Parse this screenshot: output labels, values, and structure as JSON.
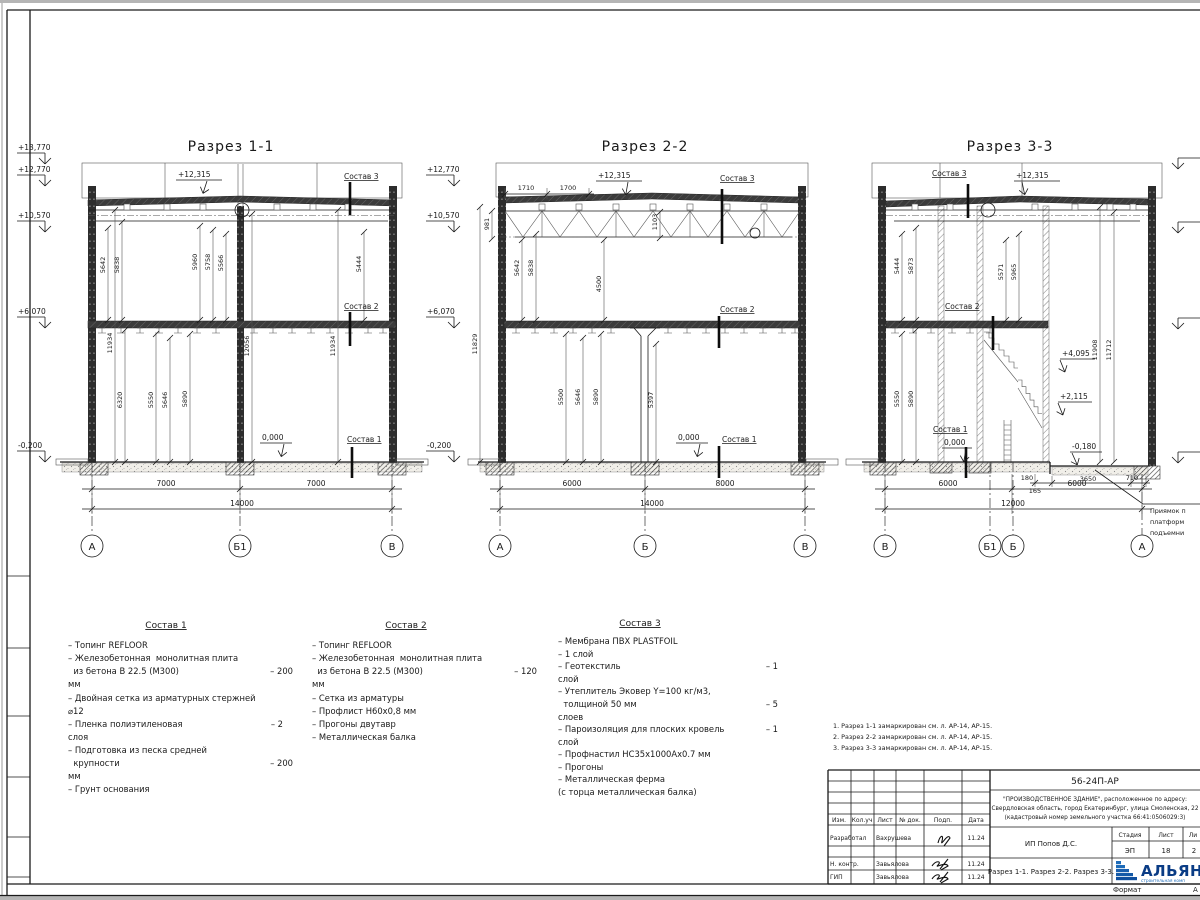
{
  "colors": {
    "line": "#1a1a1a",
    "logo_blue": "#1e6bb8",
    "logo_dark": "#0a3c85"
  },
  "margin_elevations": [
    "+13,770",
    "+12,770",
    "+10,570",
    "+6,070",
    "-0,200"
  ],
  "s1": {
    "title": "Разрез 1-1",
    "roof_elev": "+12,315",
    "sostav3": "Состав 3",
    "sostav2": "Состав 2",
    "sostav1": "Состав 1",
    "zero": "0,000",
    "dims_upper": [
      "5642",
      "5838",
      "5960",
      "5758",
      "5566",
      "5444"
    ],
    "dims_mid": [
      "11934",
      "12056",
      "11934"
    ],
    "dims_lower": [
      "6320",
      "5550",
      "5646",
      "5890"
    ],
    "dims_bottom": [
      "7000",
      "7000",
      "14000"
    ],
    "axes": [
      "А",
      "Б1",
      "В"
    ]
  },
  "s2": {
    "title": "Разрез 2-2",
    "elevations": [
      "+12,770",
      "+10,570",
      "+6,070",
      "-0,200"
    ],
    "top_dims": [
      "1710",
      "1700"
    ],
    "roof_elev": "+12,315",
    "sostav3": "Состав 3",
    "sostav2": "Состав 2",
    "sostav1": "Состав 1",
    "zero": "0,000",
    "truss_dims": [
      "981",
      "1103"
    ],
    "dims_upper": [
      "5642",
      "5838",
      "4500",
      "11829"
    ],
    "dims_lower": [
      "5500",
      "5646",
      "5890",
      "5397"
    ],
    "dims_bottom": [
      "6000",
      "8000",
      "14000"
    ],
    "axes": [
      "А",
      "Б",
      "В"
    ]
  },
  "s3": {
    "title": "Разрез 3-3",
    "sostav3": "Состав 3",
    "roof_elev": "+12,315",
    "sostav2": "Состав 2",
    "sostav1": "Состав 1",
    "zero": "0,000",
    "minus": "-0,180",
    "level_marks": [
      "+4,095",
      "+2,115"
    ],
    "dims_upper": [
      "5444",
      "5873",
      "5571",
      "5965"
    ],
    "dims_tall": [
      "11908",
      "11712"
    ],
    "dims_lower": [
      "5550",
      "5890"
    ],
    "dims_pit": [
      "180",
      "165",
      "3650",
      "710"
    ],
    "dims_bottom": [
      "6000",
      "6000",
      "12000"
    ],
    "axes": [
      "В",
      "Б1",
      "Б",
      "А"
    ],
    "pit_note": [
      "Приямок п",
      "платформ",
      "подъемни"
    ]
  },
  "compositions": [
    {
      "title": "Состав 1",
      "lines": [
        {
          "t": "– Топинг REFLOOR"
        },
        {
          "t": "– Железобетонная  монолитная плита"
        },
        {
          "t": "  из бетона В 22.5 (М300)",
          "v": "– 200"
        },
        {
          "t": "мм"
        },
        {
          "t": "– Двойная сетка из арматурных стержней"
        },
        {
          "t": "⌀12"
        },
        {
          "t": "– Пленка полиэтиленовая",
          "v": "– 2"
        },
        {
          "t": "слоя"
        },
        {
          "t": "– Подготовка из песка средней"
        },
        {
          "t": "  крупности",
          "v": "– 200"
        },
        {
          "t": "мм"
        },
        {
          "t": "– Грунт основания"
        }
      ]
    },
    {
      "title": "Состав 2",
      "lines": [
        {
          "t": "– Топинг REFLOOR"
        },
        {
          "t": "– Железобетонная  монолитная плита"
        },
        {
          "t": "  из бетона В 22.5 (М300)",
          "v": "– 120"
        },
        {
          "t": "мм"
        },
        {
          "t": "– Сетка из арматуры"
        },
        {
          "t": "– Профлист Н60х0,8 мм"
        },
        {
          "t": "– Прогоны двутавр"
        },
        {
          "t": "– Металлическая балка"
        }
      ]
    },
    {
      "title": "Состав 3",
      "lines": [
        {
          "t": "– Мембрана ПВХ PLASTFOIL"
        },
        {
          "t": "– 1 слой"
        },
        {
          "t": "– Геотекстиль",
          "v": "– 1"
        },
        {
          "t": "слой"
        },
        {
          "t": "– Утеплитель Эковер Y=100 кг/м3,"
        },
        {
          "t": "  толщиной 50 мм",
          "v": "– 5"
        },
        {
          "t": "слоев"
        },
        {
          "t": "– Пароизоляция для плоских кровель",
          "v": "– 1"
        },
        {
          "t": "слой"
        },
        {
          "t": "– Профнастил НС35х1000Ах0.7 мм"
        },
        {
          "t": "– Прогоны"
        },
        {
          "t": "– Металлическая ферма"
        },
        {
          "t": "(с торца металлическая балка)"
        }
      ]
    }
  ],
  "notes": [
    "1. Разрез 1-1 замаркирован см. л. АР-14, АР-15.",
    "2. Разрез 2-2 замаркирован см. л. АР-14, АР-15.",
    "3. Разрез 3-3 замаркирован см. л. АР-14, АР-15."
  ],
  "titleblock": {
    "code": "56-24П-АР",
    "desc": [
      "\"ПРОИЗВОДСТВЕННОЕ ЗДАНИЕ\", расположенное по адресу:",
      "Свердловская область, город Екатеринбург, улица Смоленская, 22",
      "(кадастровый номер земельного участка 66:41:0506029:3)"
    ],
    "cols": [
      "Изм.",
      "Кол.уч",
      "Лист",
      "№ док.",
      "Подп.",
      "Дата"
    ],
    "rows": [
      {
        "role": "Разработал",
        "name": "Вахрушева",
        "date": "11.24"
      },
      {
        "role": "Н. контр.",
        "name": "Завьялова",
        "date": "11.24"
      },
      {
        "role": "ГИП",
        "name": "Завьялова",
        "date": "11.24"
      }
    ],
    "client": "ИП Попов Д.С.",
    "stage_label": "Стадия",
    "stage": "ЭП",
    "sheet_label": "Лист",
    "sheet": "18",
    "sheets_label": "Ли",
    "sheets": "2",
    "doc_title": "Разрез 1-1. Разрез 2-2. Разрез 3-3.",
    "logo": "АЛЬЯН",
    "logo_sub": "строительная комп",
    "format_label": "Формат",
    "format_value": "А"
  }
}
